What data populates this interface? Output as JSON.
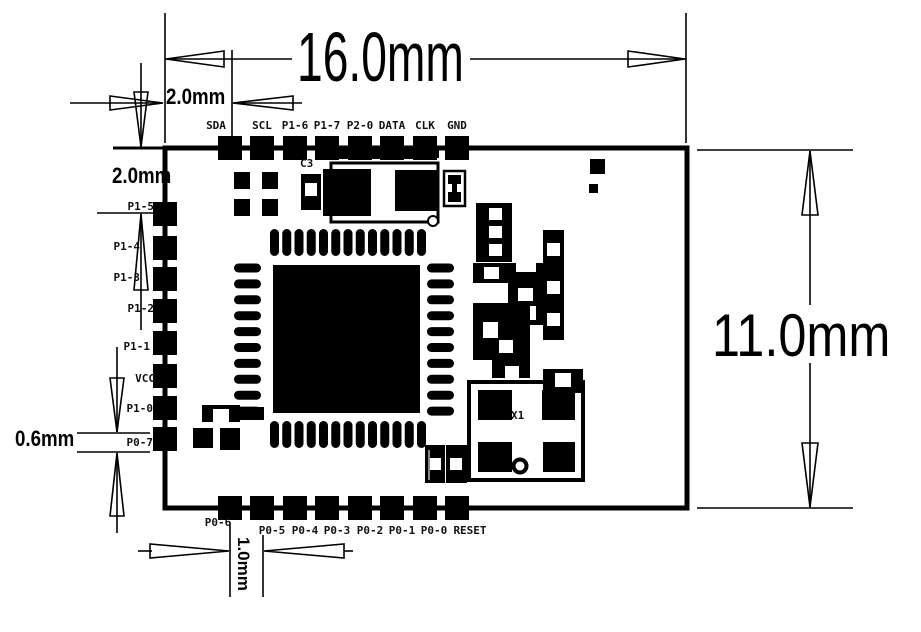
{
  "dimensions": {
    "overall_width": "16.0mm",
    "overall_height": "11.0mm",
    "top_pad_offset": "2.0mm",
    "left_pad_offset": "2.0mm",
    "pad_size": "0.6mm",
    "pad_pitch": "1.0mm"
  },
  "pins": {
    "top": [
      "SDA",
      "SCL",
      "P1-6",
      "P1-7",
      "P2-0",
      "DATA",
      "CLK",
      "GND"
    ],
    "left": [
      "P1-5",
      "P1-4",
      "P1-3",
      "P1-2",
      "P1-1",
      "VCC",
      "P1-0",
      "P0-7"
    ],
    "bottom": [
      "P0-6",
      "P0-5",
      "P0-4",
      "P0-3",
      "P0-2",
      "P0-1",
      "P0-0",
      "RESET"
    ]
  },
  "components": {
    "c3": "C3",
    "x1": "X1"
  },
  "colors": {
    "ink": "#000000",
    "board": "#ffffff"
  }
}
